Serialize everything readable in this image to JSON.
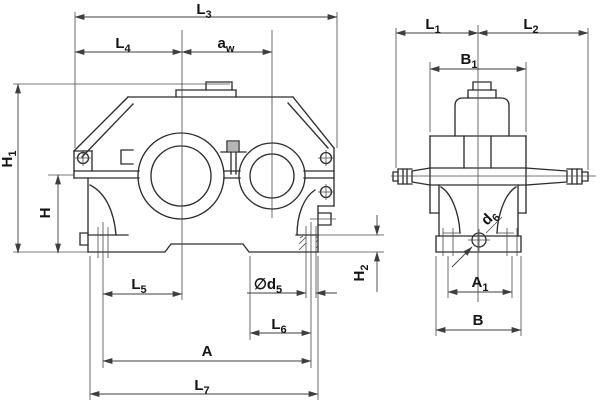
{
  "drawing": {
    "colors": {
      "background": "#ffffff",
      "object_line": "#2e2e2e",
      "dim_line": "#3e3e3e",
      "text": "#151515"
    },
    "front_view": {
      "dimensions": {
        "L3": {
          "main": "L",
          "sub": "3"
        },
        "L4": {
          "main": "L",
          "sub": "4"
        },
        "aw": {
          "main": "a",
          "sub": "w"
        },
        "H1": {
          "main": "H",
          "sub": "1"
        },
        "H": {
          "main": "H",
          "sub": ""
        },
        "H2": {
          "main": "H",
          "sub": "2"
        },
        "L5": {
          "main": "L",
          "sub": "5"
        },
        "d5": {
          "main": "∅d",
          "sub": "5"
        },
        "L6": {
          "main": "L",
          "sub": "6"
        },
        "A": {
          "main": "A",
          "sub": ""
        },
        "L7": {
          "main": "L",
          "sub": "7"
        }
      }
    },
    "side_view": {
      "dimensions": {
        "L1": {
          "main": "L",
          "sub": "1"
        },
        "L2": {
          "main": "L",
          "sub": "2"
        },
        "B1": {
          "main": "B",
          "sub": "1"
        },
        "d6": {
          "main": "d",
          "sub": "6"
        },
        "A1": {
          "main": "A",
          "sub": "1"
        },
        "B": {
          "main": "B",
          "sub": ""
        }
      }
    }
  }
}
